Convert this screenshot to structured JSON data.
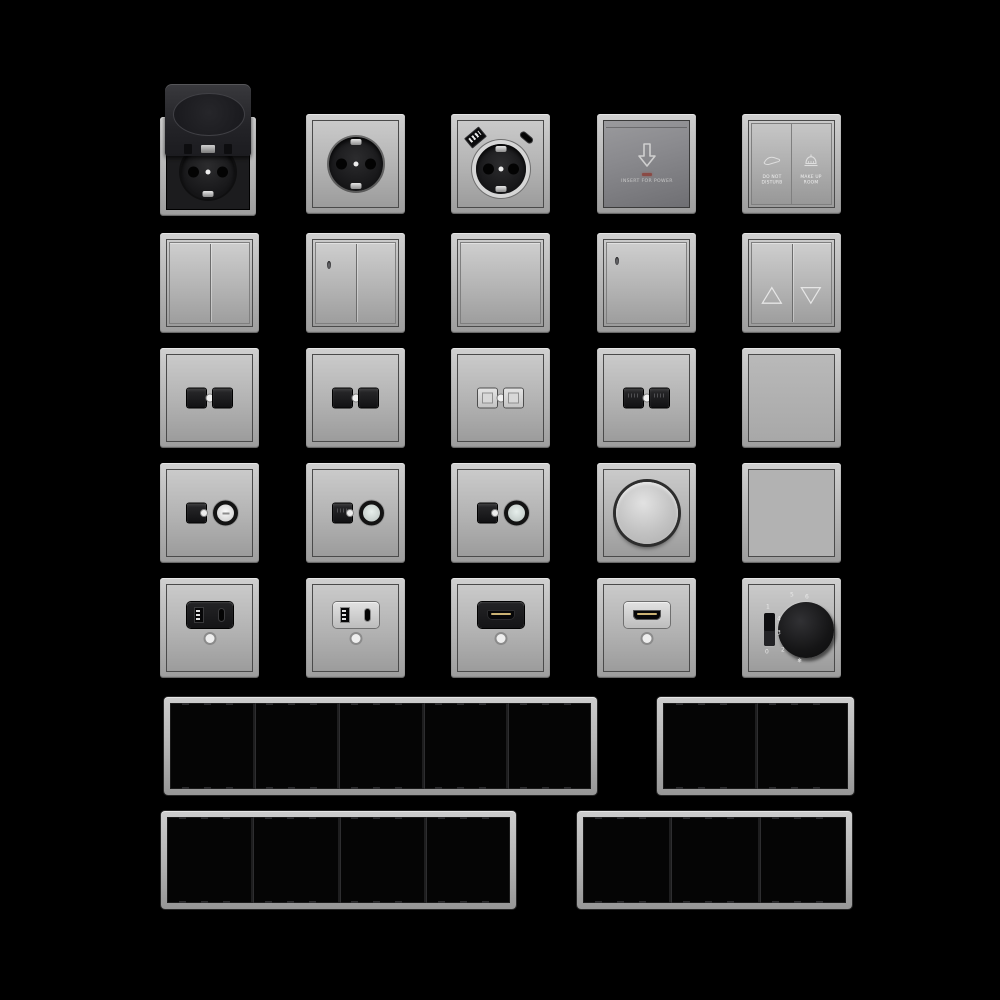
{
  "scene": {
    "background": "#000000",
    "description": "3D render catalog grid of gray electrical wall switches, sockets, outlets and multi-gang cover frames on black background"
  },
  "palette": {
    "background": "#000000",
    "frame_metal_light": "#d0d0d0",
    "frame_metal_dark": "#9d9d9d",
    "face_gradient_top": "#cacaca",
    "face_gradient_bottom": "#9c9c9c",
    "black_plastic": "#1c1c1e",
    "card_face_dark": "#6f6f73",
    "led_red": "#8a4a45",
    "hdmi_gold": "#cbb273",
    "frame_interior_black": "#050505"
  },
  "labels": {
    "card": {
      "text": "INSERT FOR POWER"
    },
    "dnd": {
      "left1": "DO NOT",
      "left2": "DISTURB",
      "right1": "MAKE UP",
      "right2": "ROOM"
    },
    "thermostat": {
      "on": "1",
      "off": "0",
      "s2": "2",
      "s3": "3",
      "s4": "4",
      "s5": "5",
      "s6": "6",
      "frost": "❄"
    }
  },
  "items": [
    {
      "name": "socket-flip-lid",
      "kind": "schuko-socket-with-hinged-lid",
      "color": "black",
      "row": 1,
      "col": 1
    },
    {
      "name": "socket-schuko",
      "kind": "schuko-socket",
      "color": "gray",
      "row": 1,
      "col": 2
    },
    {
      "name": "socket-schuko-usb",
      "kind": "schuko-socket-with-usb-a-and-usb-c",
      "color": "gray",
      "row": 1,
      "col": 3
    },
    {
      "name": "key-card-switch",
      "kind": "hotel-key-card-energy-switch",
      "label": "INSERT FOR POWER",
      "row": 1,
      "col": 4
    },
    {
      "name": "service-switch",
      "kind": "do-not-disturb-make-up-room-switch",
      "row": 1,
      "col": 5
    },
    {
      "name": "rocker-switch-2gang",
      "kind": "double-rocker-switch",
      "row": 2,
      "col": 1
    },
    {
      "name": "rocker-switch-2gang-led",
      "kind": "double-rocker-switch-with-indicator",
      "row": 2,
      "col": 2
    },
    {
      "name": "rocker-switch-1gang",
      "kind": "single-rocker-switch",
      "row": 2,
      "col": 3
    },
    {
      "name": "rocker-switch-1gang-led",
      "kind": "single-rocker-switch-with-indicator",
      "row": 2,
      "col": 4
    },
    {
      "name": "blind-switch",
      "kind": "shutter-switch-up-down-arrows",
      "row": 2,
      "col": 5
    },
    {
      "name": "data-outlet-a",
      "kind": "dual-port-data-outlet-black",
      "row": 3,
      "col": 1
    },
    {
      "name": "data-outlet-b",
      "kind": "dual-port-data-outlet-black",
      "row": 3,
      "col": 2
    },
    {
      "name": "data-outlet-c",
      "kind": "dual-port-data-outlet-light",
      "row": 3,
      "col": 3
    },
    {
      "name": "data-outlet-d",
      "kind": "dual-port-data-outlet-black-pins",
      "row": 3,
      "col": 4
    },
    {
      "name": "blank-cover-a",
      "kind": "blind-cover-plate",
      "row": 3,
      "col": 5
    },
    {
      "name": "tv-data-outlet-a",
      "kind": "data-jack-with-coax-connector",
      "row": 4,
      "col": 1
    },
    {
      "name": "tv-data-outlet-b",
      "kind": "data-jack-with-coax-connector",
      "row": 4,
      "col": 2
    },
    {
      "name": "tv-data-outlet-c",
      "kind": "data-jack-with-coax-connector",
      "row": 4,
      "col": 3
    },
    {
      "name": "rotary-dimmer",
      "kind": "rotary-dimmer-knob",
      "row": 4,
      "col": 4
    },
    {
      "name": "blank-cover-b",
      "kind": "blind-cover-plate",
      "row": 4,
      "col": 5
    },
    {
      "name": "usb-charger-black",
      "kind": "usb-a-usb-c-charger-outlet-black",
      "row": 5,
      "col": 1
    },
    {
      "name": "usb-charger-light",
      "kind": "usb-a-usb-c-charger-outlet-light",
      "row": 5,
      "col": 2
    },
    {
      "name": "hdmi-outlet-black",
      "kind": "hdmi-outlet-black",
      "row": 5,
      "col": 3
    },
    {
      "name": "hdmi-outlet-light",
      "kind": "hdmi-outlet-light",
      "row": 5,
      "col": 4
    },
    {
      "name": "thermostat",
      "kind": "rotary-thermostat-with-switch",
      "markings": [
        "0",
        "1",
        "2",
        "3",
        "4",
        "5",
        "6",
        "❄"
      ],
      "row": 5,
      "col": 5
    },
    {
      "name": "frame-5gang",
      "kind": "cover-frame",
      "gangs": 5
    },
    {
      "name": "frame-2gang",
      "kind": "cover-frame",
      "gangs": 2
    },
    {
      "name": "frame-4gang",
      "kind": "cover-frame",
      "gangs": 4
    },
    {
      "name": "frame-3gang",
      "kind": "cover-frame",
      "gangs": 3
    }
  ]
}
